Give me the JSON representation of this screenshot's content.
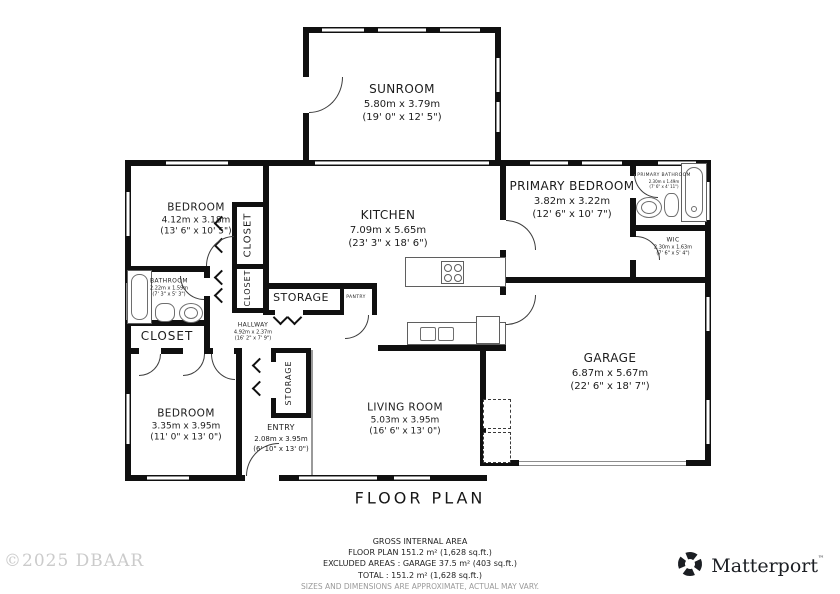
{
  "title": "FLOOR PLAN",
  "watermark": "©2025 DBAAR",
  "brand": {
    "name": "Matterport",
    "tm": "™",
    "icon": "matterport-pinwheel-icon",
    "color": "#1b1e23"
  },
  "footer": {
    "lines": [
      "GROSS INTERNAL AREA",
      "FLOOR PLAN 151.2 m² (1,628 sq.ft.)",
      "EXCLUDED AREAS :  GARAGE 37.5 m² (403 sq.ft.)",
      "TOTAL :  151.2 m² (1,628 sq.ft.)"
    ],
    "disclaimer": "SIZES AND DIMENSIONS ARE APPROXIMATE, ACTUAL MAY VARY."
  },
  "rooms": {
    "sunroom": {
      "name": "SUNROOM",
      "metric": "5.80m x 3.79m",
      "imperial": "(19' 0\" x 12' 5\")"
    },
    "bedroom1": {
      "name": "BEDROOM",
      "metric": "4.12m x 3.18m",
      "imperial": "(13' 6\" x 10' 5\")"
    },
    "kitchen": {
      "name": "KITCHEN",
      "metric": "7.09m x 5.65m",
      "imperial": "(23' 3\" x 18' 6\")"
    },
    "primary_bedroom": {
      "name": "PRIMARY BEDROOM",
      "metric": "3.82m x 3.22m",
      "imperial": "(12' 6\" x 10' 7\")"
    },
    "primary_bathroom": {
      "name": "PRIMARY BATHROOM",
      "metric": "2.30m x 1.49m",
      "imperial": "(7' 6\" x 4' 11\")"
    },
    "wic": {
      "name": "WIC",
      "metric": "2.30m x 1.63m",
      "imperial": "(7' 6\" x 5' 4\")"
    },
    "bathroom": {
      "name": "BATHROOM",
      "metric": "2.22m x 1.59m",
      "imperial": "(7' 3\" x 5' 3\")"
    },
    "hallway": {
      "name": "HALLWAY",
      "metric": "4.92m x 2.37m",
      "imperial": "(16' 2\" x 7' 9\")"
    },
    "bedroom2": {
      "name": "BEDROOM",
      "metric": "3.35m x 3.95m",
      "imperial": "(11' 0\" x 13' 0\")"
    },
    "entry": {
      "name": "ENTRY",
      "metric": "2.08m x 3.95m",
      "imperial": "(6' 10\" x 13' 0\")"
    },
    "living_room": {
      "name": "LIVING ROOM",
      "metric": "5.03m x 3.95m",
      "imperial": "(16' 6\" x 13' 0\")"
    },
    "garage": {
      "name": "GARAGE",
      "metric": "6.87m x 5.67m",
      "imperial": "(22' 6\" x 18' 7\")"
    },
    "closet_upper": {
      "name": "CLOSET"
    },
    "closet_lower": {
      "name": "CLOSET"
    },
    "closet_hall": {
      "name": "CLOSET"
    },
    "storage": {
      "name": "STORAGE"
    },
    "pantry": {
      "name": "PANTRY"
    },
    "storage_entry": {
      "name": "STORAGE"
    }
  }
}
